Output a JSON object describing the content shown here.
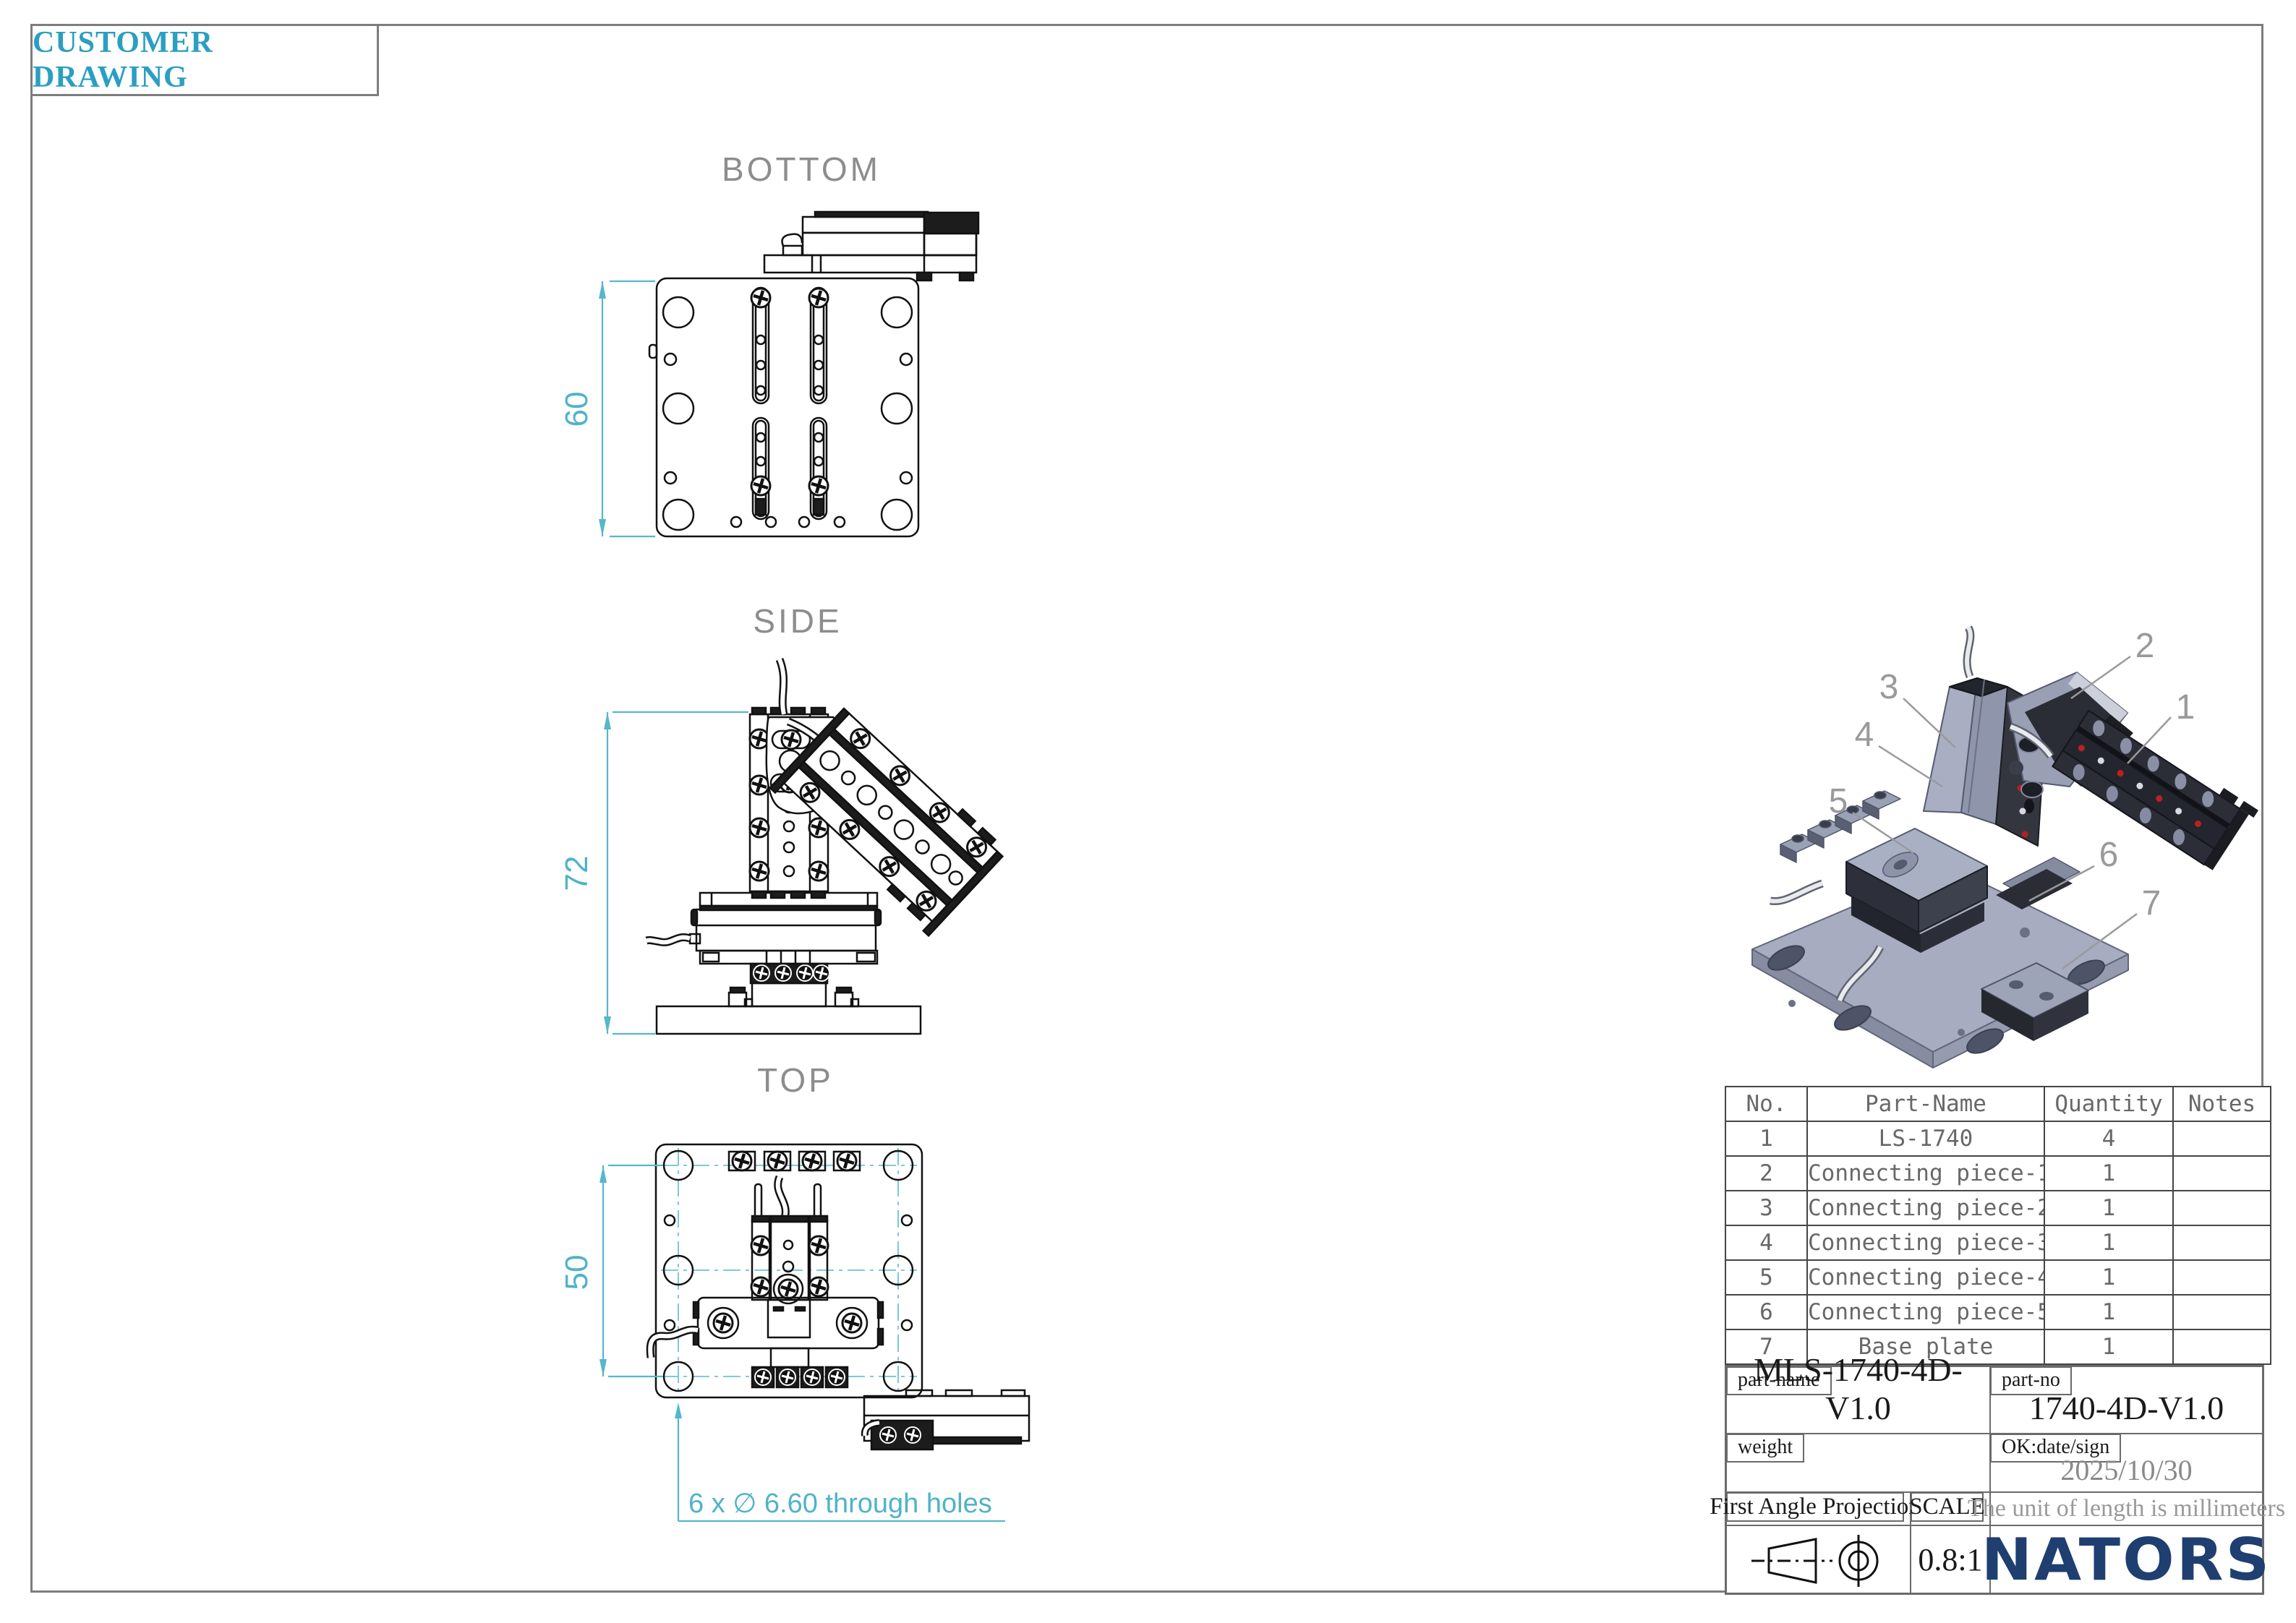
{
  "frame": {
    "title": "CUSTOMER DRAWING"
  },
  "views": {
    "bottom": {
      "label": "BOTTOM",
      "dim": "60"
    },
    "side": {
      "label": "SIDE",
      "dim": "72"
    },
    "top": {
      "label": "TOP",
      "dim": "50",
      "hole_note": "6 x ∅ 6.60 through holes"
    }
  },
  "callouts": [
    "1",
    "2",
    "3",
    "4",
    "5",
    "6",
    "7"
  ],
  "parts_table": {
    "headers": {
      "no": "No.",
      "name": "Part-Name",
      "qty": "Quantity",
      "notes": "Notes"
    },
    "rows": [
      {
        "no": "1",
        "name": "LS-1740",
        "qty": "4",
        "notes": ""
      },
      {
        "no": "2",
        "name": "Connecting piece-1",
        "qty": "1",
        "notes": ""
      },
      {
        "no": "3",
        "name": "Connecting piece-2",
        "qty": "1",
        "notes": ""
      },
      {
        "no": "4",
        "name": "Connecting piece-3",
        "qty": "1",
        "notes": ""
      },
      {
        "no": "5",
        "name": "Connecting piece-4",
        "qty": "1",
        "notes": ""
      },
      {
        "no": "6",
        "name": "Connecting piece-5",
        "qty": "1",
        "notes": ""
      },
      {
        "no": "7",
        "name": "Base plate",
        "qty": "1",
        "notes": ""
      }
    ]
  },
  "title_block": {
    "part_name_label": "part-name",
    "part_name": "MLS-1740-4D-V1.0",
    "part_no_label": "part-no",
    "part_no": "1740-4D-V1.0",
    "weight_label": "weight",
    "ok_label": "OK:date/sign",
    "date": "2025/10/30",
    "projection_label": "First Angle Projection",
    "scale_label": "SCALE",
    "scale_value": "0.8:1",
    "unit_note": "The unit of length is millimeters",
    "brand": "NATORS"
  },
  "colors": {
    "accent_teal": "#4fb3c9",
    "title_teal": "#2a9fc1",
    "muted_gray": "#8d8d8d",
    "brand_navy": "#1e3f70"
  }
}
